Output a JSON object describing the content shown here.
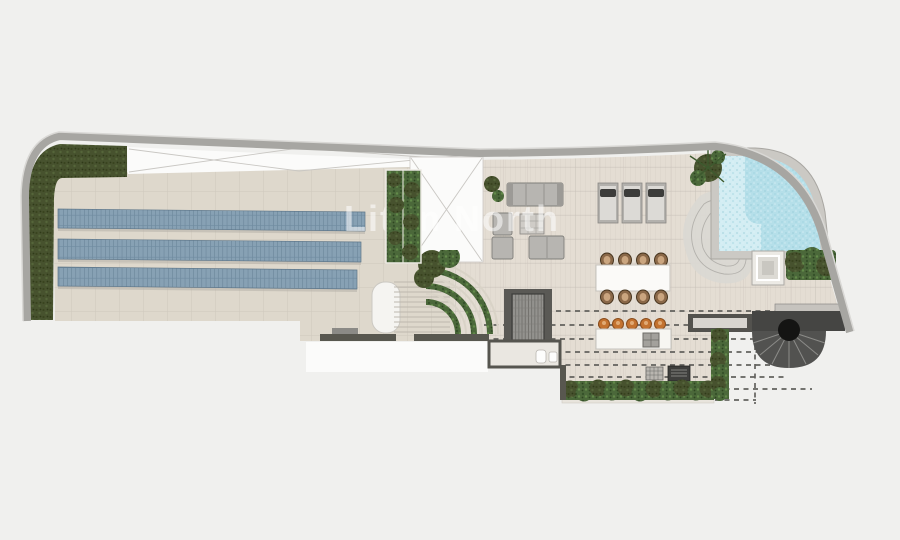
{
  "watermark": {
    "text": "Liton North"
  },
  "plan_summary": {
    "type": "rooftop-terrace-floor-plan",
    "solar_panel_rows": 3,
    "sun_loungers": 3,
    "dining_chairs": 8,
    "bar_stools": 5
  },
  "colors": {
    "background": "#f0f0ee",
    "border": "#a7a6a2",
    "floor": "#ded8cc",
    "floor_right": "#e4ddd3",
    "white_void": "#fbfbfa",
    "hedge_dark": "#47522e",
    "planting_green": "#4b683a",
    "solar_panel_blue": "#87a1b4",
    "pool_water": "#b5dfe9",
    "pool_step": "#d3edf3",
    "pool_coping": "#cbc9c4",
    "wall_dark": "#58574f",
    "bar_stool_orange": "#c3722f",
    "dining_chair_brown": "#8a6848",
    "stair_dark": "#525250"
  }
}
